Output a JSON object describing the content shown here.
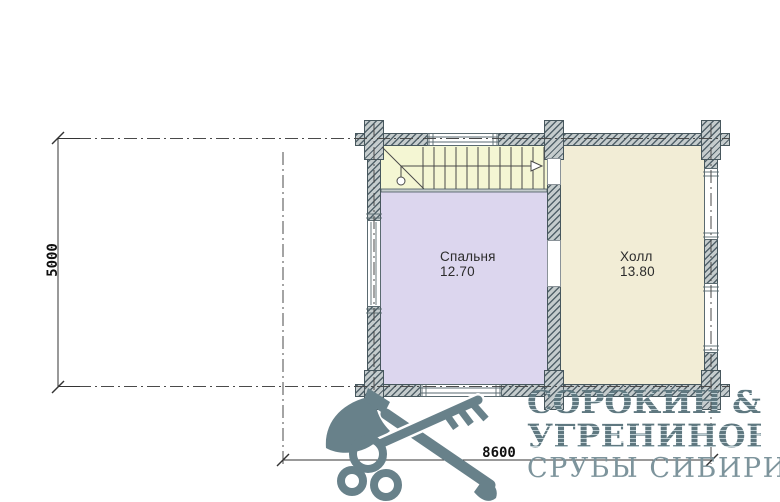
{
  "plan": {
    "title_hint": "second-floor plan of log house",
    "rooms": {
      "stairs": {
        "name": "лестница"
      },
      "bedroom": {
        "name": "Спальня",
        "area": "12.70"
      },
      "hall": {
        "name": "Холл",
        "area": "13.80"
      }
    },
    "dimensions": {
      "vertical": "5000",
      "horizontal": "8600"
    }
  },
  "logo": {
    "name_line_1": "СОРОКИН",
    "ampersand": "&",
    "name_line_2": "УГРЕНИНОВ",
    "tagline": "СРУБЫ СИБИРИ"
  },
  "icons": {
    "logo_icon": "crossed-axe-and-key"
  },
  "colors": {
    "wall_fill": "#c5cccd",
    "wall_hatch": "#52626a",
    "stairs_fill": "#f4f6d3",
    "bedroom_fill": "#dcd6ee",
    "hall_fill": "#f2edd6",
    "logo_main": "#5d757e",
    "logo_light": "#7d949c",
    "line_dark": "#3c3c3c"
  }
}
